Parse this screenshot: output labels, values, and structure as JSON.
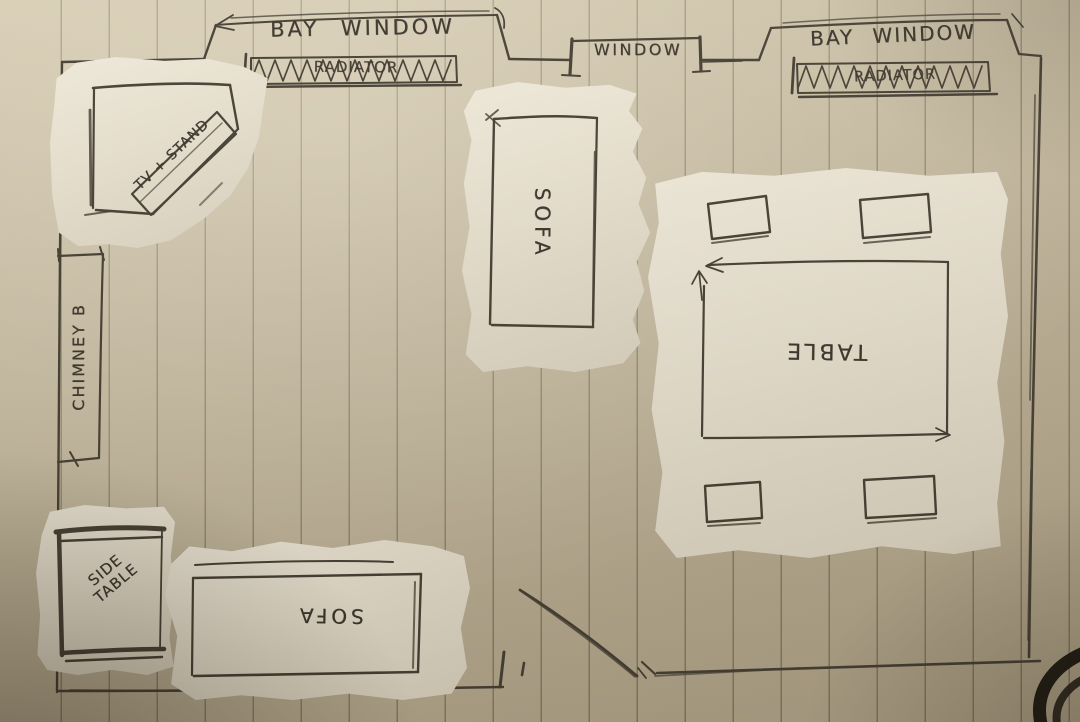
{
  "scene_type": "hand-drawn room floor plan on lined paper with torn-paper furniture cutouts",
  "colors": {
    "paper": "#c9bda2",
    "torn_paper": "#e9e2d1",
    "ink": "#39332a",
    "ruled_line": "#8a8066"
  },
  "room": {
    "bay_window_left_label": "BAY WINDOW",
    "radiator_left_label": "RADIATOR",
    "window_label": "WINDOW",
    "bay_window_right_label": "BAY WINDOW",
    "radiator_right_label": "RADIATOR",
    "chimney_label": "CHIMNEY B"
  },
  "furniture": {
    "tv_stand": {
      "label": "TV + STAND"
    },
    "sofa_top": {
      "label": "SOFA"
    },
    "dining_table": {
      "label": "TABLE",
      "chair_count": 4
    },
    "side_table": {
      "label": "SIDE TABLE"
    },
    "sofa_bottom": {
      "label": "SOFA"
    }
  }
}
